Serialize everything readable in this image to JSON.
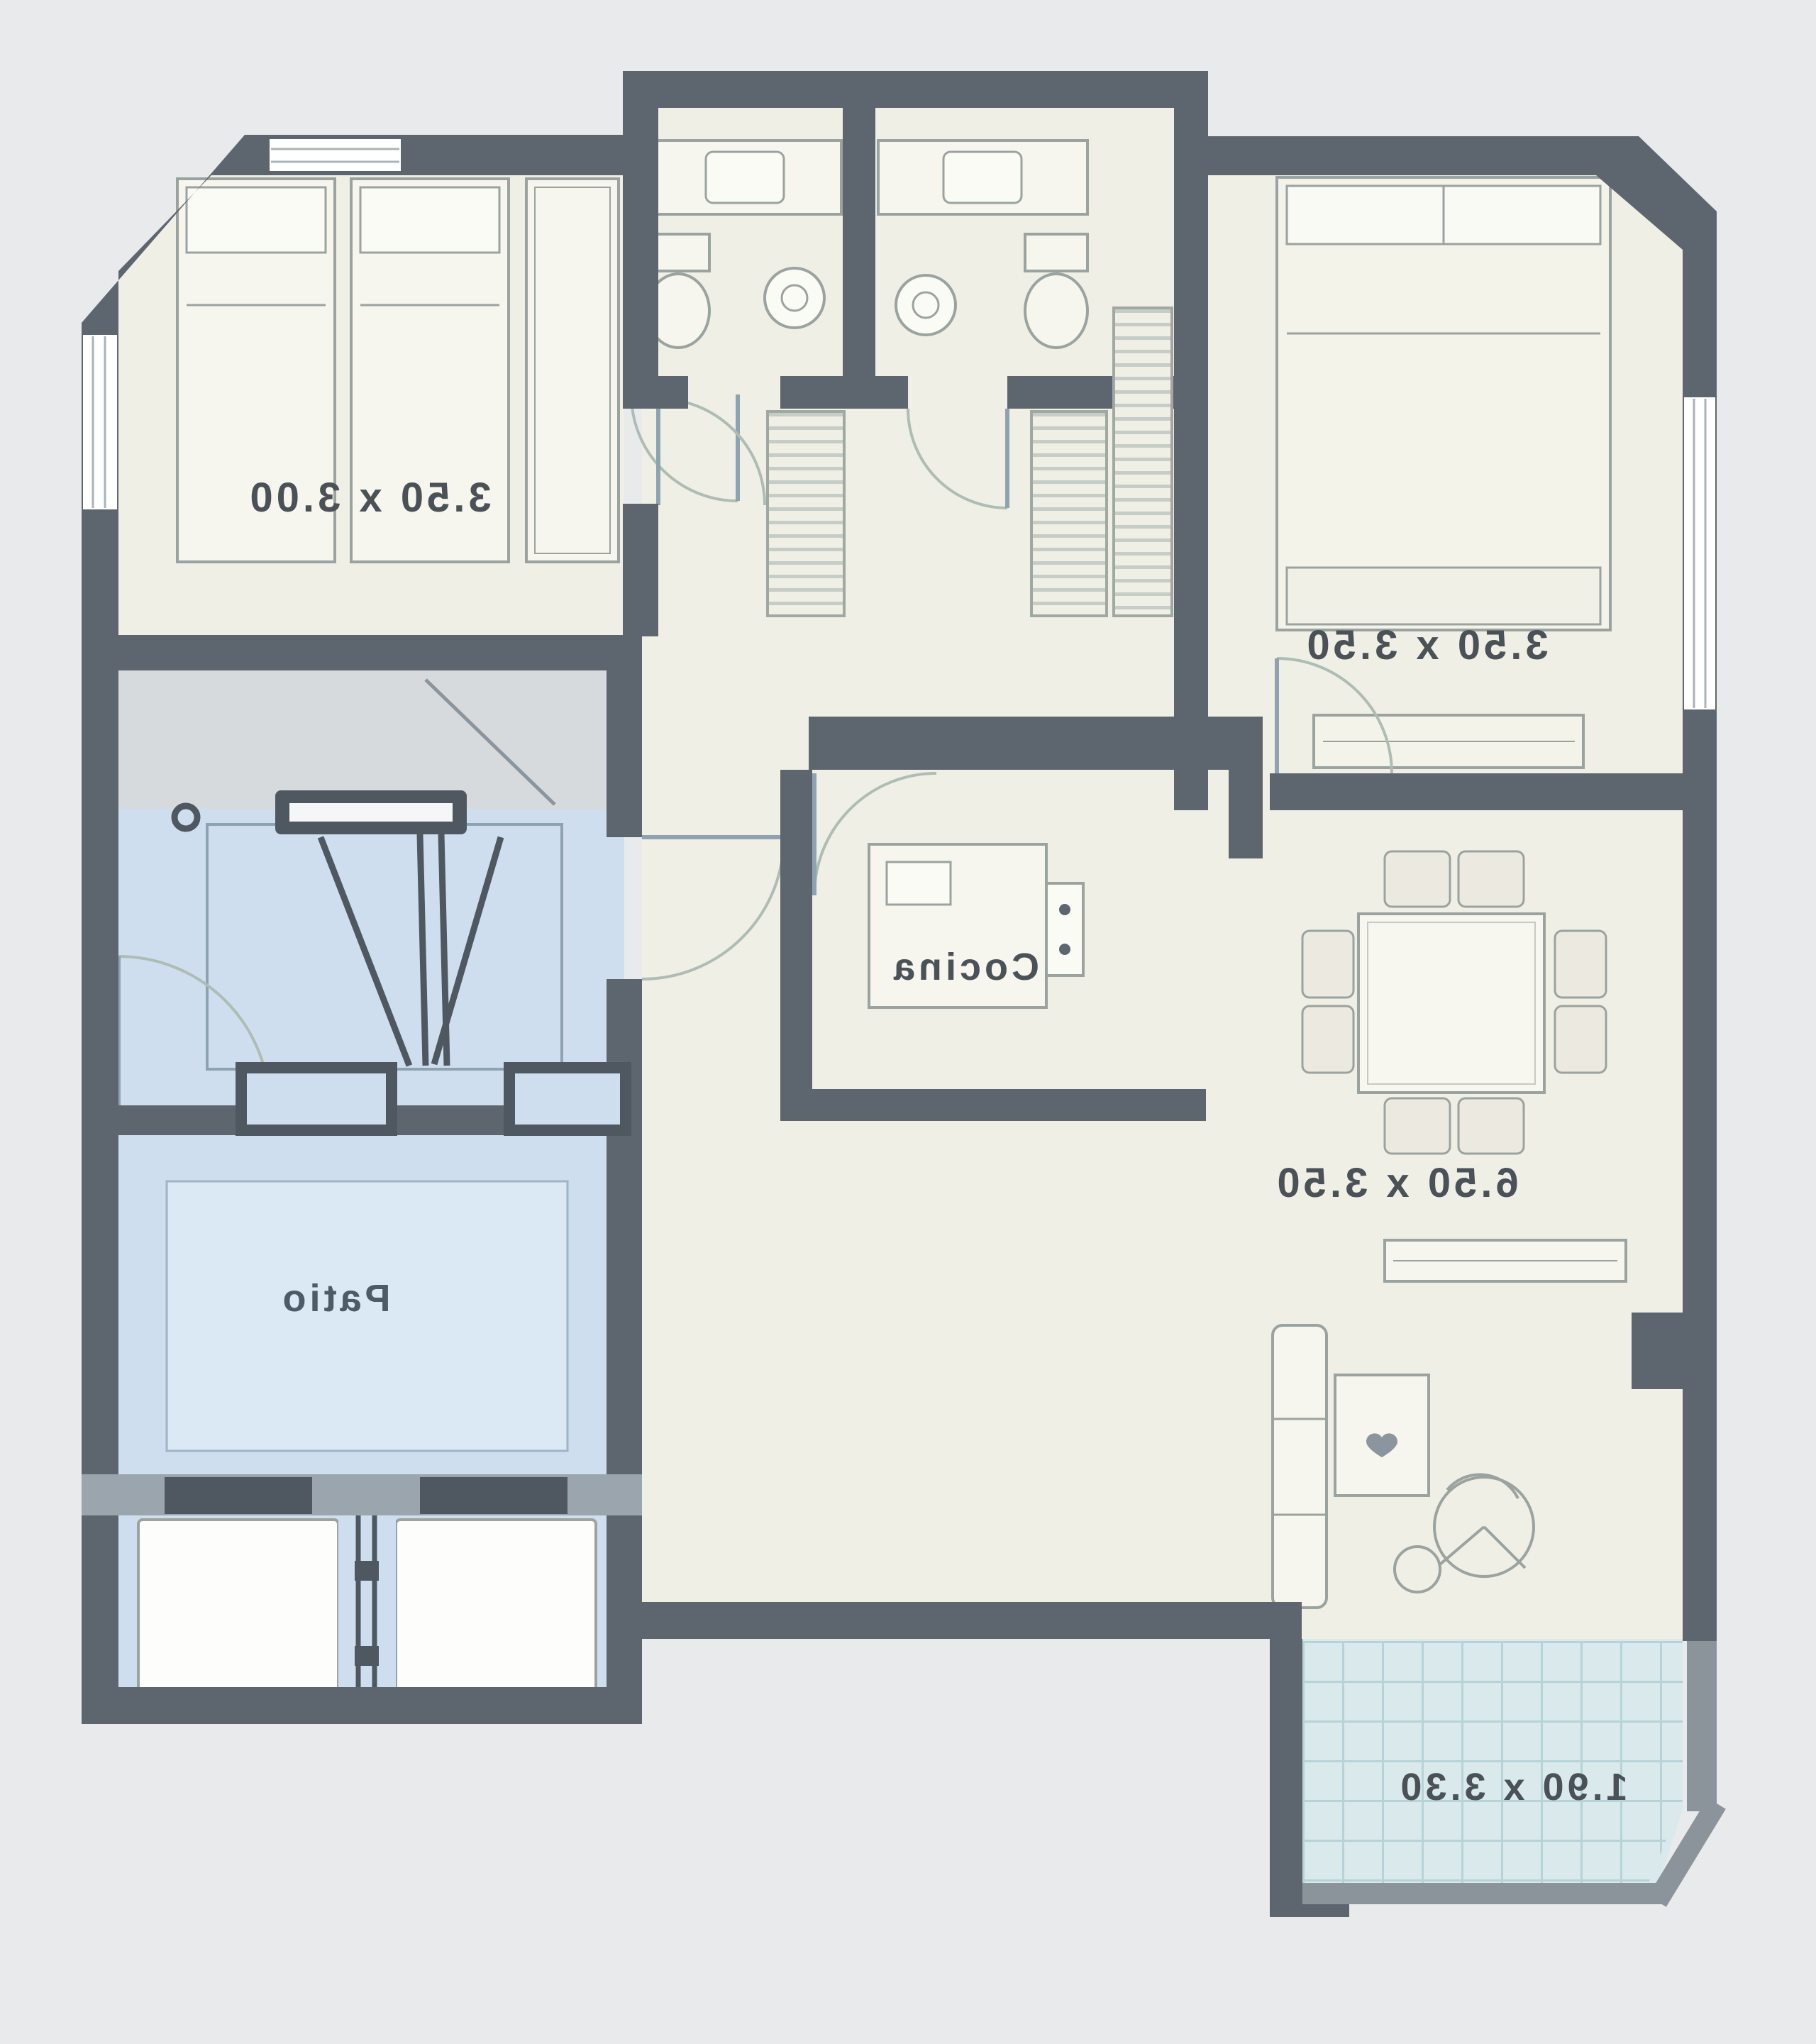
{
  "plan": {
    "type": "architectural floor plan",
    "mirrored_text": true,
    "labels": {
      "bedroom1": "3.50 x 3.00",
      "bedroom2": "3.50 x 3.50",
      "kitchen": "Cocina",
      "living_dining": "6.50 x 3.50",
      "patio": "Patio",
      "balcony": "1.90 x 3.30"
    },
    "colors": {
      "background": "#e9eaec",
      "wall": "#5d666f",
      "wall_dark": "#4f5861",
      "floor": "#f0efe6",
      "core_blue": "#cfdeee",
      "patio_inner": "#dbe9f5",
      "balcony_tile": "#d9e9ec",
      "tile_grid": "#b7d3d7",
      "furniture_stroke": "#9aa39f",
      "label_text": "#4b5257"
    }
  }
}
